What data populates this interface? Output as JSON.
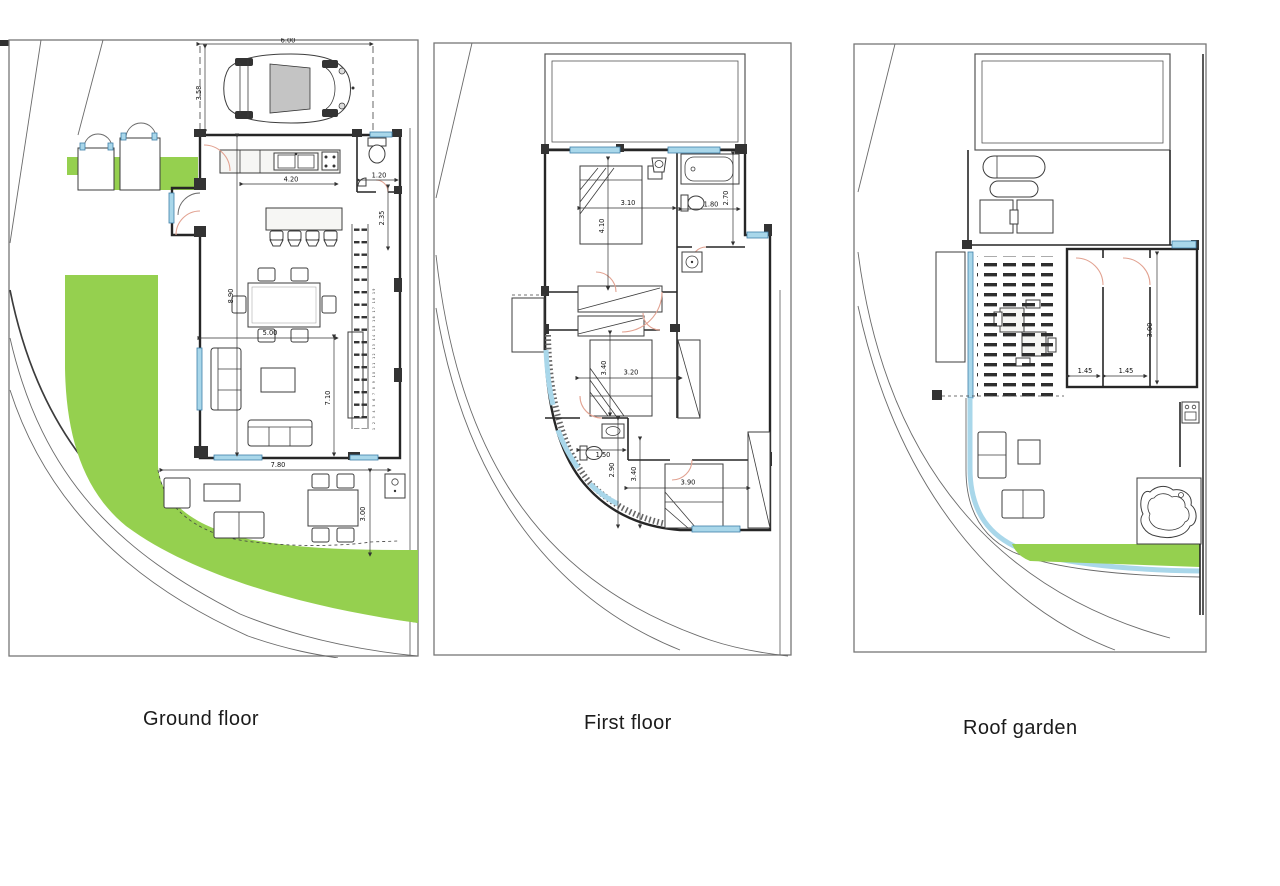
{
  "page": {
    "type": "architectural floor plan sheet",
    "background": "#ffffff"
  },
  "colors": {
    "lawn": "#95d04f",
    "window_blue": "#a9d7ea",
    "door_arc": "#e2a291",
    "wall": "#262626",
    "site_line": "#6a6a6a"
  },
  "panels": {
    "ground": {
      "label": "Ground floor",
      "dims": {
        "carport_width": "6.00",
        "carport_depth": "3.58",
        "kitchen_width": "4.20",
        "wc_width": "1.20",
        "wc_depth": "2.35",
        "living_depth": "8.90",
        "living_width": "5.00",
        "east_side_depth": "7.10",
        "terrace_width": "7.80",
        "terrace_depth": "3.00"
      },
      "stair_numbers": "1 2 3 4 5 6 7 8 9 10 11 12 13 14 15 16 17 18 19"
    },
    "first": {
      "label": "First floor",
      "dims": {
        "bedroom1_width": "3.10",
        "bedroom1_depth": "4.10",
        "bathroom_width": "1.80",
        "bathroom_depth": "2.70",
        "bedroom2_depth": "3.40",
        "bedroom2_width": "3.20",
        "wc_width": "1.50",
        "hall_depth": "2.90",
        "bedroom3_depth": "3.40",
        "bedroom3_width": "3.90"
      }
    },
    "roof": {
      "label": "Roof garden",
      "dims": {
        "store_room1_width": "1.45",
        "store_room2_width": "1.45",
        "store_depth": "3.00"
      }
    }
  }
}
